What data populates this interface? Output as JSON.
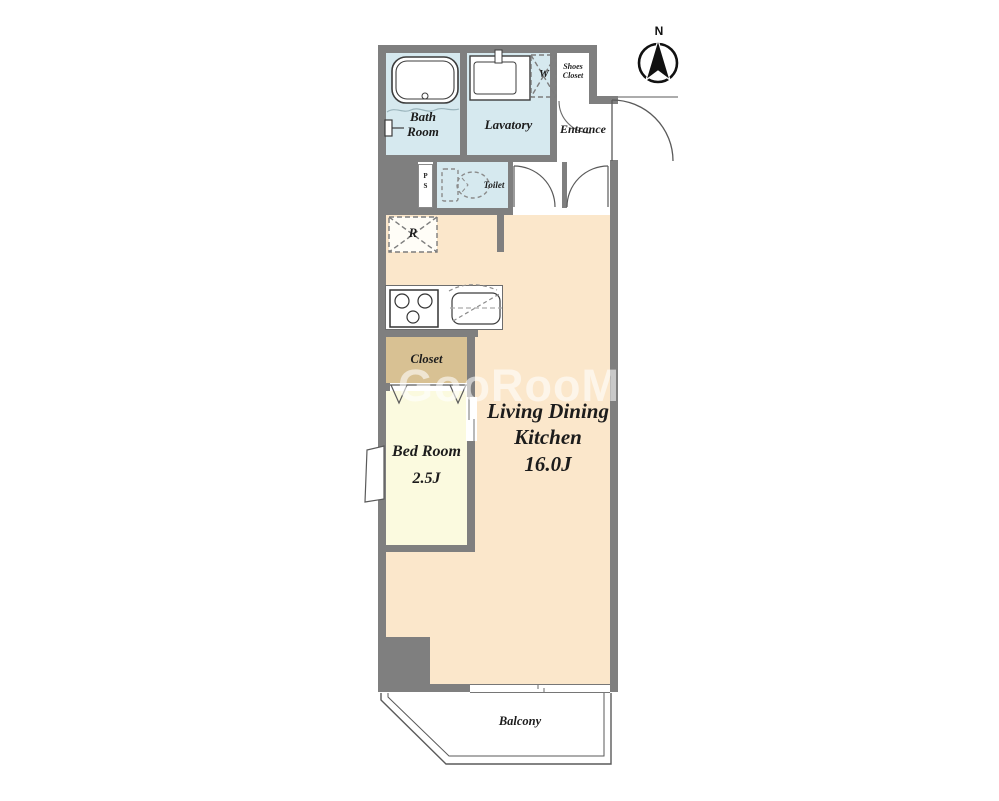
{
  "compass": {
    "label": "N"
  },
  "watermark": {
    "text": "GooRooM"
  },
  "colors": {
    "wall": "#7f7f7f",
    "wet_area_floor": "#d6e9ef",
    "ldk_floor": "#fbe7cb",
    "bedroom_floor": "#fbfadf",
    "closet_floor": "#d8c193",
    "balcony_floor": "#ffffff"
  },
  "rooms": {
    "bath_room": {
      "label_line1": "Bath",
      "label_line2": "Room"
    },
    "lavatory": {
      "label": "Lavatory"
    },
    "shoes_closet": {
      "label_line1": "Shoes",
      "label_line2": "Closet"
    },
    "entrance": {
      "label": "Entrance"
    },
    "toilet": {
      "label": "Toilet"
    },
    "pipe_space": {
      "label_line1": "P",
      "label_line2": "S"
    },
    "washing_machine": {
      "label": "W"
    },
    "refrigerator": {
      "label": "R"
    },
    "closet": {
      "label": "Closet"
    },
    "bed_room": {
      "label": "Bed Room",
      "size": "2.5J"
    },
    "living_dining_kitchen": {
      "label_line1": "Living Dining",
      "label_line2": "Kitchen",
      "size": "16.0J"
    },
    "balcony": {
      "label": "Balcony"
    }
  }
}
